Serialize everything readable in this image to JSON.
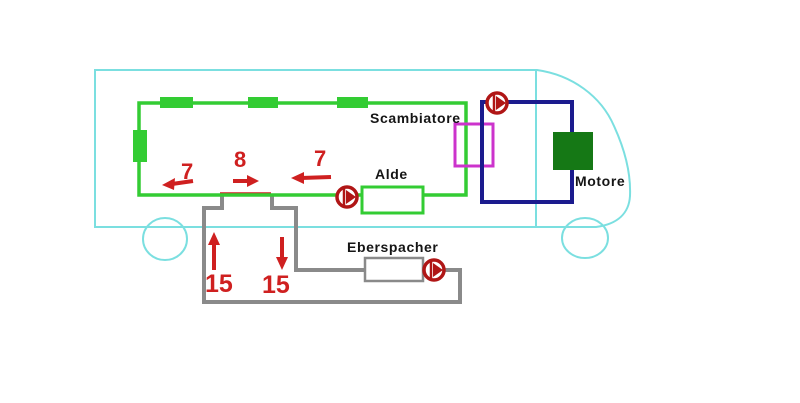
{
  "labels": {
    "scambiatore": "Scambiatore",
    "alde": "Alde",
    "motore": "Motore",
    "eberspacher": "Eberspacher"
  },
  "flow_numbers": {
    "left_7": "7",
    "center_8": "8",
    "right_7": "7",
    "up_15": "15",
    "down_15": "15"
  },
  "colors": {
    "vehicle_outline": "#7bdfe0",
    "radiator_circuit": "#33cc33",
    "engine_circuit": "#1b1b8e",
    "heat_exchanger": "#cc33cc",
    "engine_block": "#157815",
    "eberspacher_circuit": "#8a8a8a",
    "flow_marks": "#cf2020",
    "pump": "#b01616",
    "label_text": "#151515"
  }
}
